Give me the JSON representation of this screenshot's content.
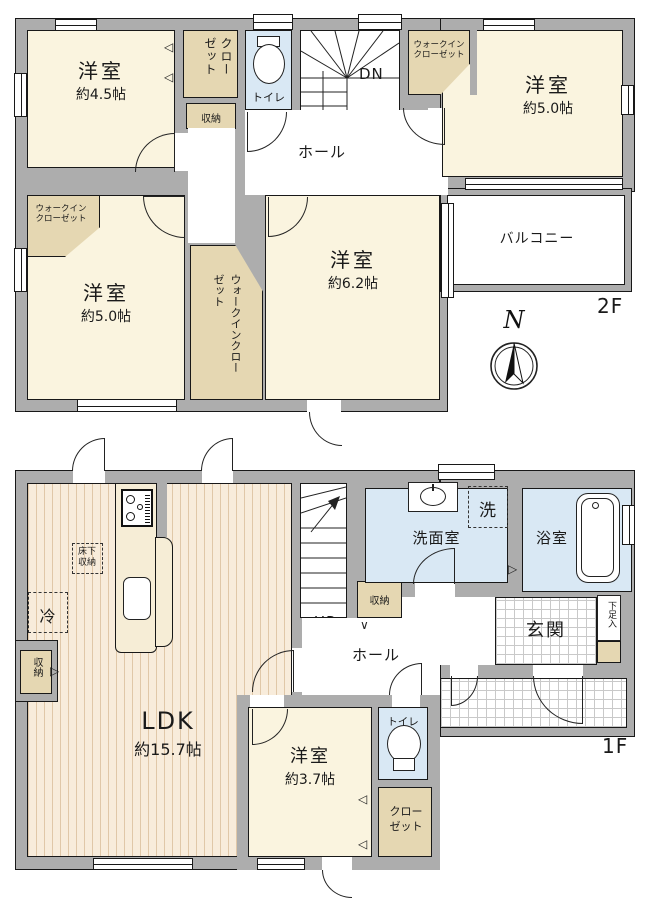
{
  "colors": {
    "wall": "#adadad",
    "room_cream": "#faf4df",
    "closet_tan": "#e5d7b2",
    "wet_blue": "#d9e8f4",
    "wood_floor": "#f8ecdb",
    "line": "#1a1a1a"
  },
  "f2": {
    "floor_label": "2F",
    "room_nw": {
      "name": "洋室",
      "size": "約4.5帖"
    },
    "closet": "クローゼット",
    "storage": "収納",
    "toilet": "トイレ",
    "stairs_dir": "DN",
    "hall": "ホール",
    "wic_ne": "ウォークイン クローゼット",
    "room_ne": {
      "name": "洋室",
      "size": "約5.0帖"
    },
    "wic_w": "ウォークイン クローゼット",
    "room_sw": {
      "name": "洋室",
      "size": "約5.0帖"
    },
    "wic_c": "ウォークインクローゼット",
    "room_se": {
      "name": "洋室",
      "size": "約6.2帖"
    },
    "balcony": "バルコニー",
    "compass": "N"
  },
  "f1": {
    "floor_label": "1F",
    "ldk": {
      "name": "LDK",
      "size": "約15.7帖"
    },
    "stairs_dir": "UP",
    "hall": "ホール",
    "storage_stairs": "収納",
    "storage_wall": "収納",
    "fridge": "冷",
    "underfloor": "床下収納",
    "washroom": "洗面室",
    "laundry": "洗",
    "bath": "浴室",
    "entrance": "玄関",
    "shoe_box": "下足入",
    "room_s": {
      "name": "洋室",
      "size": "約3.7帖"
    },
    "toilet": "トイレ",
    "closet": "クローゼット"
  }
}
